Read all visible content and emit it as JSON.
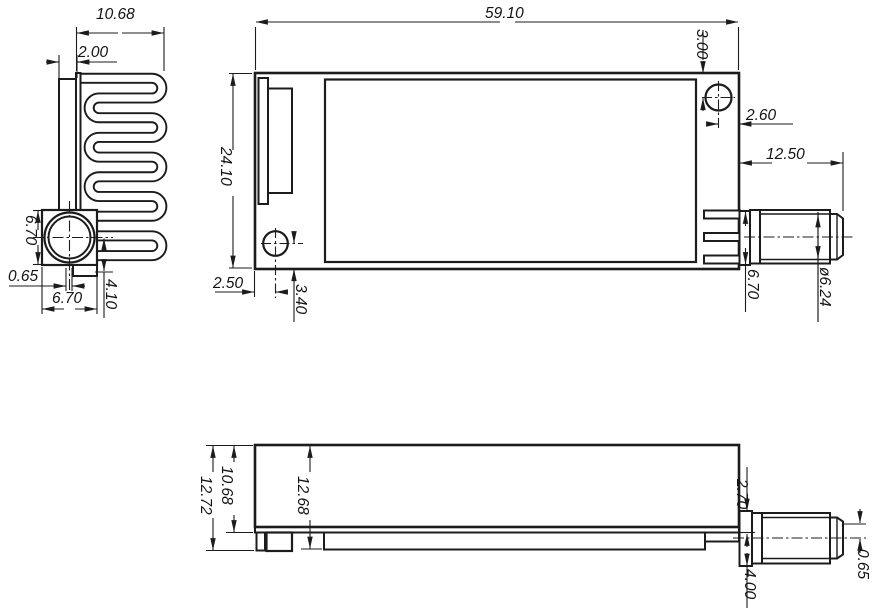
{
  "drawing": {
    "type": "mechanical-dimension-drawing",
    "background_color": "#ffffff",
    "line_color": "#1c1c1c",
    "views": [
      "side-view-heatsink",
      "top-view-module",
      "front-view-module"
    ],
    "dims": {
      "side": {
        "fin_width": "10.68",
        "plate_thickness": "2.00",
        "block_height": "6.70",
        "edge_offset": "0.65",
        "block_width": "6.70",
        "center_to_base": "4.10"
      },
      "top": {
        "overall_length": "59.10",
        "overall_width": "24.10",
        "hole_top": "3.00",
        "hole_right": "2.60",
        "connector_length": "12.50",
        "hole_left": "2.50",
        "hole_bottom": "3.40",
        "flange_width": "6.70",
        "thread_diameter": "ø6.24"
      },
      "front": {
        "overall_height": "12.72",
        "body_height": "10.68",
        "board_height": "12.68",
        "connector_offset": "2.70",
        "connector_height": "4.00",
        "pin_offset": "0.65"
      }
    }
  }
}
